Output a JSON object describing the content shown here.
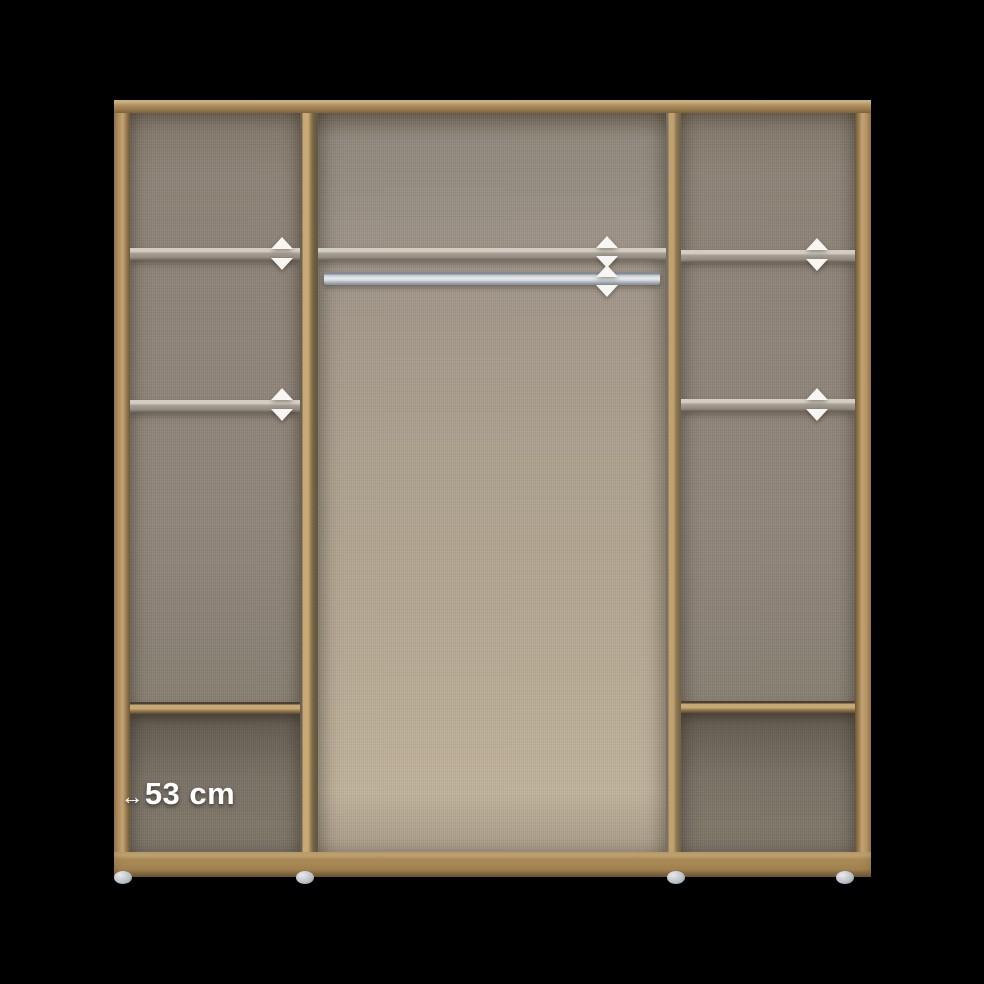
{
  "scene": {
    "background_color": "#000000",
    "description": "Product image of an open three-section wardrobe interior shown on a black background"
  },
  "wardrobe": {
    "dimension_label": {
      "arrow_icon": "↔",
      "value": "53 cm"
    },
    "colors": {
      "background_color": "#000000",
      "frame_oak": "#b2905d",
      "frame_oak_dark": "#6e5c3c",
      "side_panel_back": "#8d8276",
      "center_panel_back_top": "#9c9286",
      "center_panel_back_bottom": "#c0b29c",
      "shelf_adjustable": "#958d82",
      "shelf_adjustable_edge": "#d4cdc1",
      "rail_silver": "#d7dce1",
      "arrow_white": "#f7f6f3",
      "foot_gray": "#b9bfc6"
    },
    "sections": [
      {
        "name": "left",
        "adjustable_shelves": 2,
        "fixed_shelves": 1,
        "hanging_rails": 0
      },
      {
        "name": "center",
        "adjustable_shelves": 1,
        "fixed_shelves": 0,
        "hanging_rails": 1
      },
      {
        "name": "right",
        "adjustable_shelves": 2,
        "fixed_shelves": 1,
        "hanging_rails": 0
      }
    ],
    "indicators": {
      "meaning": "white up/down arrows mark height-adjustable shelves and rail",
      "count": 12
    },
    "feet_count": 4
  }
}
